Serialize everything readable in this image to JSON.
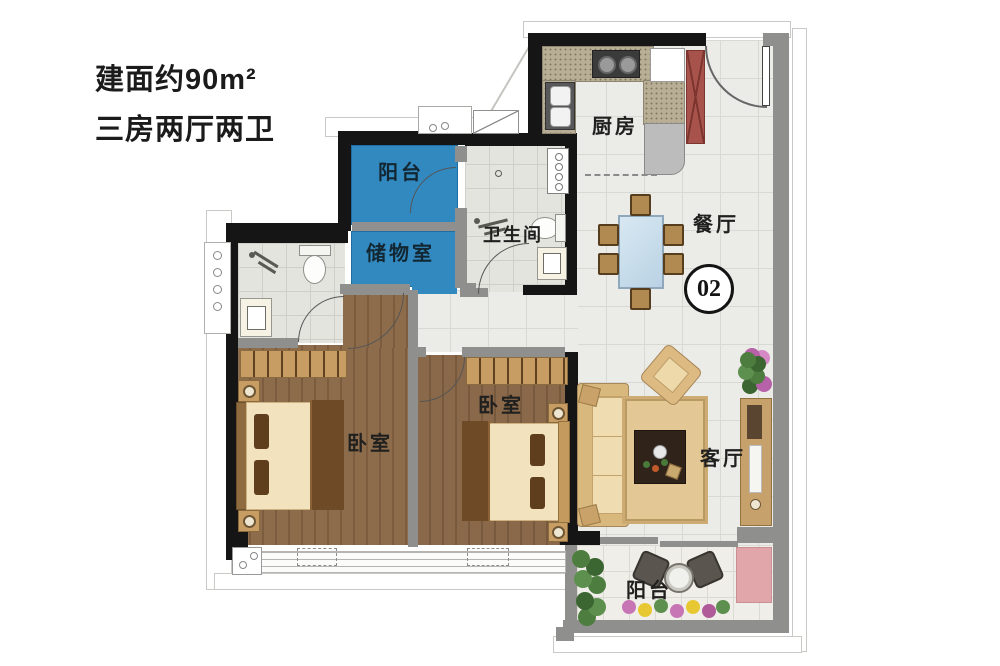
{
  "title": {
    "area": "建面约90m²",
    "layout": "三房两厅两卫"
  },
  "unit": {
    "number": "02"
  },
  "rooms": {
    "balcony_top": {
      "label": "阳台"
    },
    "storage": {
      "label": "储物室"
    },
    "bathroom": {
      "label": "卫生间"
    },
    "kitchen": {
      "label": "厨房"
    },
    "dining": {
      "label": "餐厅"
    },
    "living": {
      "label": "客厅"
    },
    "bedroom_master": {
      "label": "卧室"
    },
    "bedroom_second": {
      "label": "卧室"
    },
    "balcony_bottom": {
      "label": "阳台"
    }
  },
  "colors": {
    "accent_blue": "#3289c0",
    "wall_black": "#151515",
    "wall_gray": "#8f8f8d",
    "wood_floor": "#8d6c4c",
    "fridge_red": "#a7524a",
    "mat_pink": "#e0a6aa",
    "furniture_tan": "#c89d64"
  }
}
